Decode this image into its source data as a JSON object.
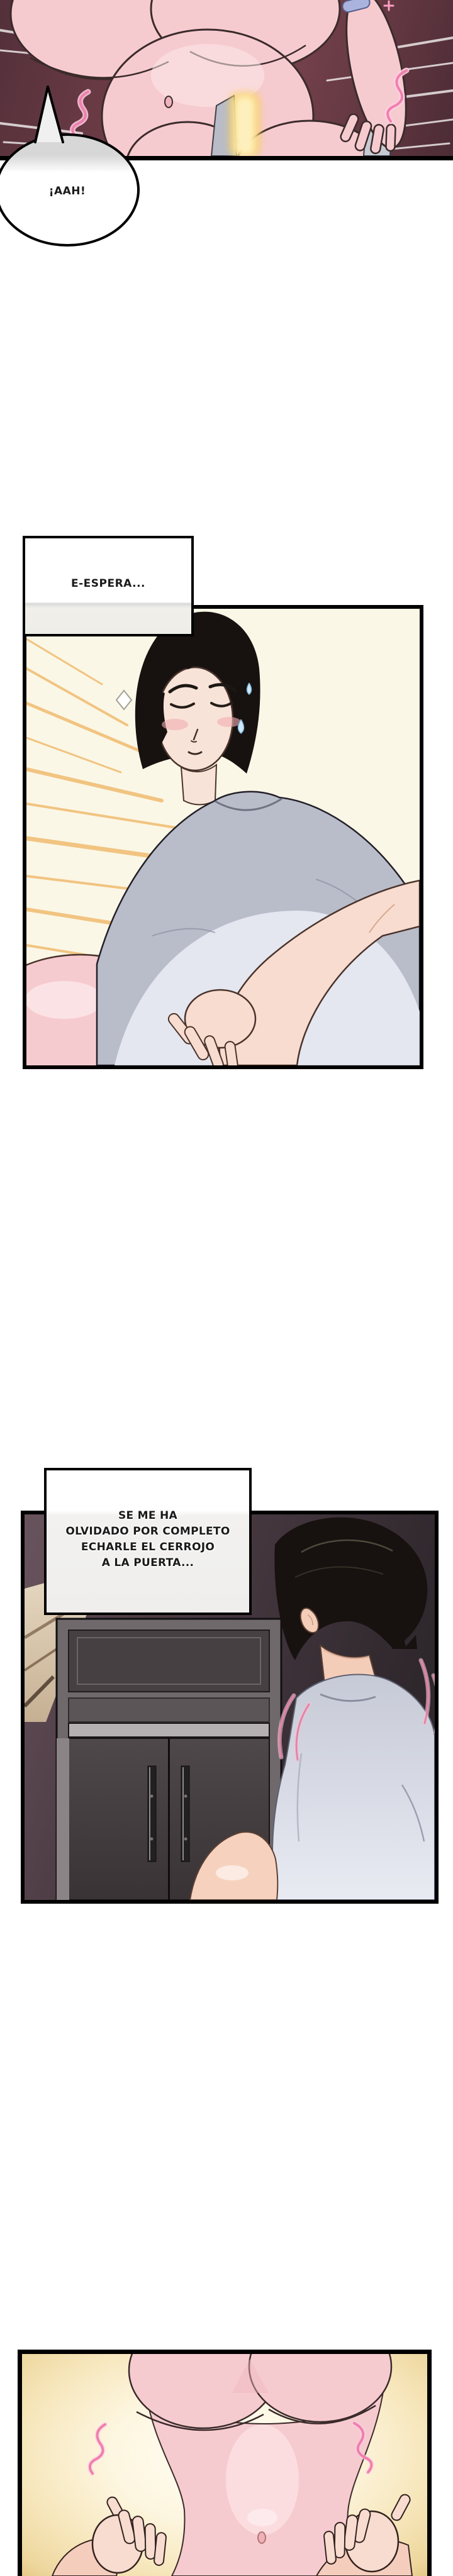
{
  "speech_bubble": {
    "text": "¡AAH!"
  },
  "caption1": {
    "text": "E-ESPERA..."
  },
  "caption2": {
    "line1": "SE ME HA",
    "line2": "OLVIDADO POR COMPLETO",
    "line3": "ECHARLE EL CERROJO",
    "line4": "A LA PUERTA..."
  },
  "colors": {
    "page_bg": "#ffffff",
    "panel_border": "#000000",
    "text": "#1a1a1a",
    "bubble_white": "#ffffff",
    "panel1_bg": "#6d3c46",
    "panel2_bg": "#fbf7e6",
    "panel3_bg": "#463740",
    "panel4_glow": "#eed79e",
    "skin_pink": "#f6cbcf",
    "skin_warm": "#f4cdb9",
    "skin_hand": "#f8dcd0",
    "face_tone": "#f8e3d8",
    "outline": "#3b2b2b",
    "outline_warm": "#4a332c",
    "hair": "#171210",
    "tee_grey": "#b9bdc9",
    "tee_light": "#e9ebf3",
    "door_grey": "#474042",
    "frame_grey": "#6f696b",
    "strip_light": "#b5b0b2",
    "hall_beige": "#ddcdb8",
    "ray_orange": "#efb768",
    "hatch_tan": "#a3824e",
    "fx_pink": "#f07fae",
    "sweat_blue": "#cfe9fa",
    "glow_gold": "#f7c94e"
  }
}
